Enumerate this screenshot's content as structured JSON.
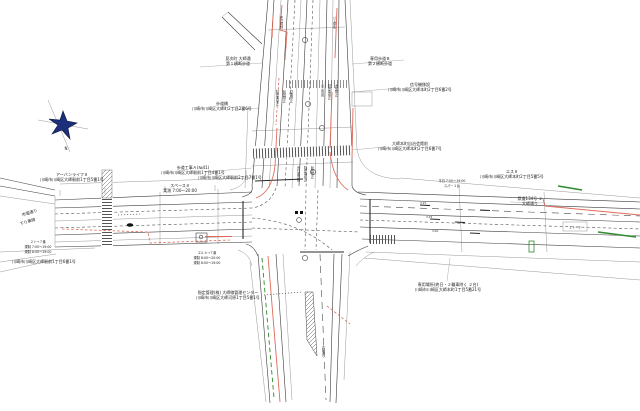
{
  "drawing": {
    "compass_label": "N",
    "labels": {
      "a1": "見次町 大師通",
      "a2": "第１横断歩道",
      "b1": "専用歩道Ｂ",
      "b2": "第２横断歩道",
      "c1": "信号機移設",
      "c2": "川崎市川崎区大師本町2丁目6番2号",
      "d1": "歩道橋",
      "d2": "川崎市川崎区大師町2丁目2番6号",
      "e1": "大師本町自治会館前",
      "e2": "川崎市川崎区大師本町2丁目6番7号",
      "f1": "川崎市川崎区大師駅前2丁目7番1号",
      "g1": "アーバンライフ８",
      "g2": "川崎市川崎区大師駅前1丁目5番1号",
      "h1": "歩道工事Ａ(№41)",
      "h2": "川崎市川崎区大師駅前1丁目4番1号",
      "i1": "スペース８",
      "i2": "実測 7:00〜20:00",
      "j1": "市電通り",
      "j2": "下り車線",
      "k1": "２ト→７番",
      "k2": "規制 7:00〜19:00",
      "k3": "規制 8:00〜19:00",
      "l1": "川崎市川崎区大師駅前1丁目6番1号",
      "m1": "エル４→７番",
      "m2": "規制 8:00〜20:00",
      "m3": "規制 8:00〜19:00",
      "n1": "指定管理(株) 大師線管理センター",
      "n2": "川崎市川崎区大師河原1丁目5番1号",
      "o1": "平日 7:00〜19:00",
      "o2": "スパー１台",
      "p1": "エス８",
      "p2": "川崎市川崎区大師本町2丁目5番5号",
      "q1": "県道134号 ２",
      "q2": "大師通り",
      "r1": "２ト−３",
      "s1": "専用場所(終日・２輪車除く ２台)",
      "s2": "川崎市川崎区大師本町1丁目5番21号"
    },
    "lane_texts": {
      "v1": "駐停車禁止",
      "v2": "転回禁止",
      "v3": "駐車禁止",
      "v4": "バス専用",
      "v5": "駐停車禁止",
      "v6": "大型禁止",
      "v7": "歩行者専用",
      "v8": "駐停車禁止",
      "v9": "転回禁止",
      "v10": "終日規制",
      "v11": "バス優先",
      "v12": "大師通り"
    },
    "lane_widths": {
      "w1": "3.25",
      "w2": "3.25",
      "w3": "3.00"
    },
    "colors": {
      "regulation_red": "#e06a5a",
      "route_green": "#2e8b2e",
      "compass_navy": "#1b2f7a",
      "line_dark": "#3c3c3c"
    }
  }
}
